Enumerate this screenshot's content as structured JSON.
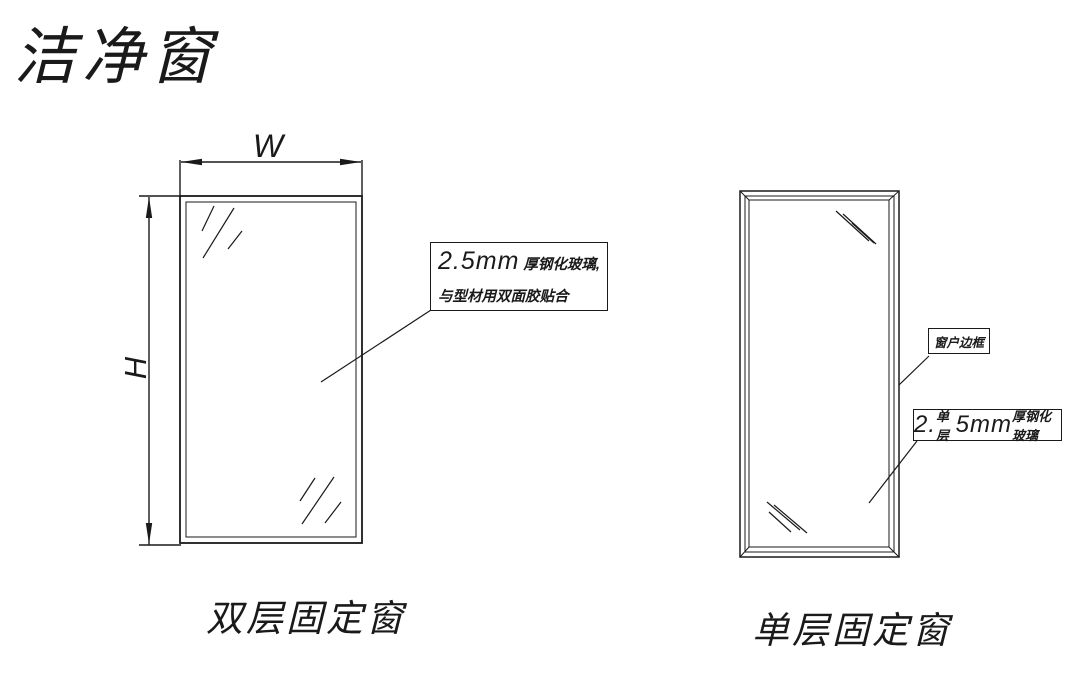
{
  "title": "洁净窗",
  "colors": {
    "line": "#1a1a1a",
    "background": "#ffffff"
  },
  "left_figure": {
    "caption": "双层固定窗",
    "width_dim_label": "W",
    "height_dim_label": "H",
    "glass_annotation": {
      "size": "2.5mm",
      "desc": " 厚钢化玻璃, 与型材用双面胶贴合"
    }
  },
  "right_figure": {
    "caption": "单层固定窗",
    "frame_annotation": "窗户边框",
    "glass_annotation": {
      "index": "2.",
      "layer": "单层",
      "size": "5mm",
      "desc": " 厚钢化玻璃"
    }
  }
}
